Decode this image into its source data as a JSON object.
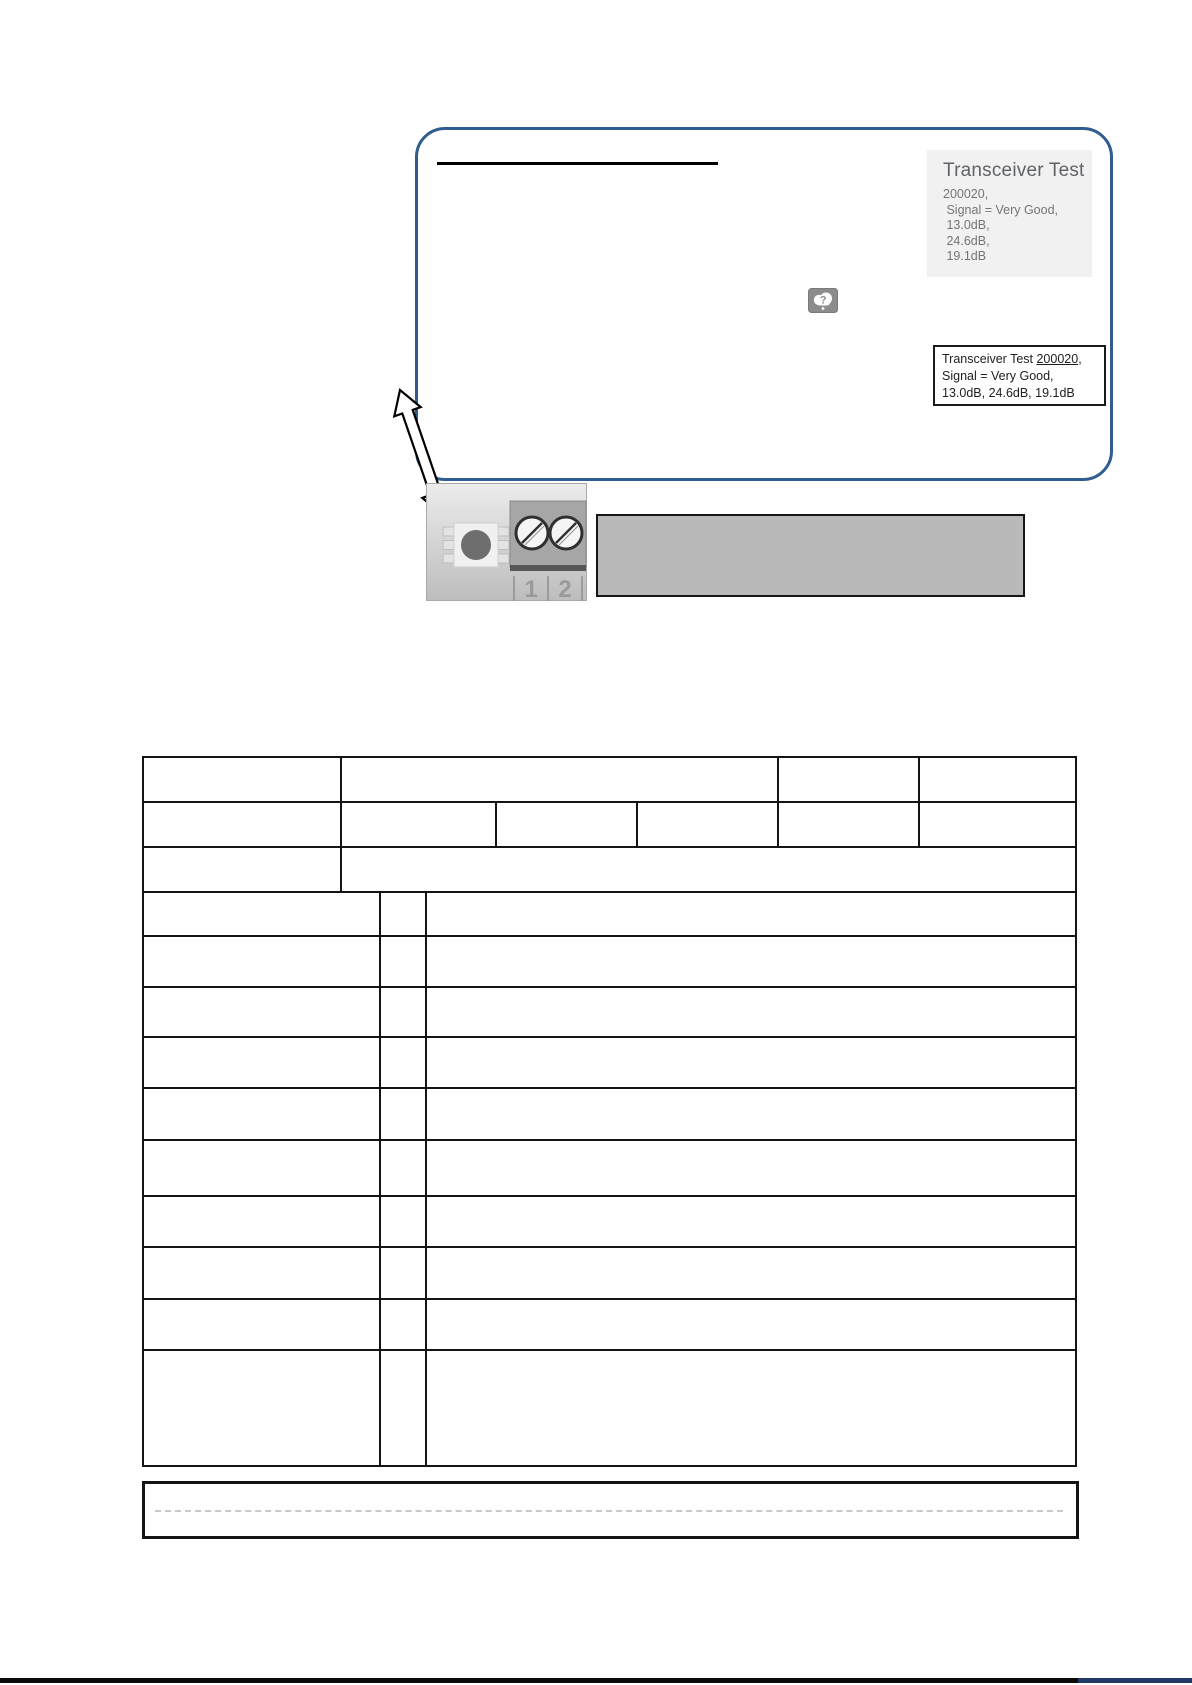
{
  "colors": {
    "accent_blue": "#2f5d8f",
    "panel_gray": "#f1f1f1",
    "box_gray": "#b9b9b9",
    "line_black": "#141414",
    "text_dark": "#212121",
    "text_gray": "#757575",
    "heading_gray": "#5f6368",
    "footer_blue": "#1f3864"
  },
  "screenshot": {
    "heading": "Transceiver Test",
    "detail_lines": [
      "200020,",
      " Signal = Very Good,",
      " 13.0dB,",
      " 24.6dB,",
      " 19.1dB"
    ],
    "icons": [
      "broken-image-icon"
    ]
  },
  "callout": {
    "line1_prefix": "Transceiver Test ",
    "line1_link": "200020",
    "line1_suffix": ",",
    "line2": "Signal = Very Good,",
    "line3": "13.0dB, 24.6dB, 19.1dB"
  },
  "device": {
    "terminal_labels": [
      "1",
      "2"
    ]
  }
}
